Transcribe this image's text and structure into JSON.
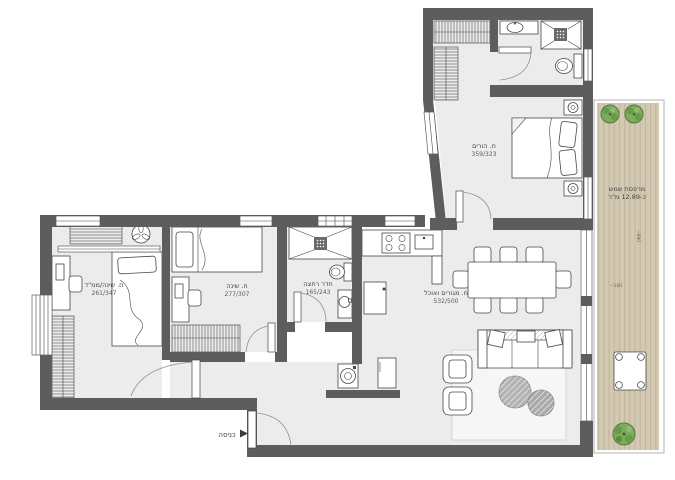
{
  "colors": {
    "wall": "#5d5d5d",
    "floor": "#ececec",
    "stroke": "#474747",
    "deck": "#d3c8b1",
    "deck_line": "#bdb199",
    "plant": "#7dab5c",
    "plant_dark": "#4f7d38",
    "bg": "#ffffff"
  },
  "rooms": {
    "master_bedroom": {
      "name": "ח. הורים",
      "dims": "359/323"
    },
    "safe_room": {
      "name": "ח. שינה/ממ\"ד",
      "dims": "261/347"
    },
    "bedroom": {
      "name": "ח. שינה",
      "dims": "277/307"
    },
    "bathroom": {
      "name": "חדר רחצה",
      "dims": "165/243"
    },
    "living_dining": {
      "name": "ח. מגורים ואוכל",
      "dims": "532/500"
    },
    "terrace": {
      "name": "מרפסת שמש",
      "area": "כ-12.89 מ\"ר"
    }
  },
  "entrance": {
    "label": "כניסה"
  },
  "terrace_dims": {
    "width": "~160",
    "length": "~880"
  }
}
